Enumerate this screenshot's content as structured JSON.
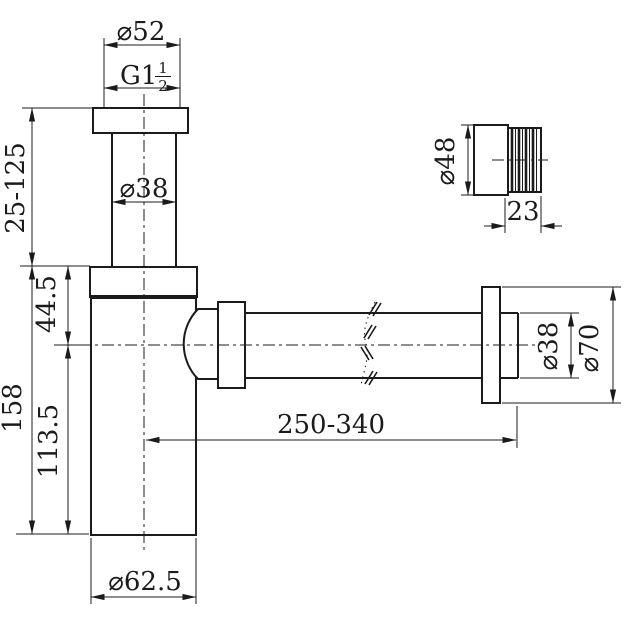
{
  "colors": {
    "line_color": "#1b1b1b",
    "background": "#ffffff"
  },
  "dimensions": {
    "inlet_flange_diameter": "⌀52",
    "thread_size_prefix": "G1",
    "thread_size_numerator": "1",
    "thread_size_denominator": "2",
    "inlet_pipe_diameter": "⌀38",
    "inlet_adjustable_height": "25-125",
    "body_top_to_outlet_center": "44.5",
    "body_total_height": "158",
    "outlet_center_to_body_bottom": "113.5",
    "body_diameter": "⌀62.5",
    "outlet_adjustable_length": "250-340",
    "outlet_pipe_diameter": "⌀38",
    "outlet_flange_diameter": "⌀70",
    "wall_connector_diameter": "⌀48",
    "wall_connector_length": "23"
  }
}
